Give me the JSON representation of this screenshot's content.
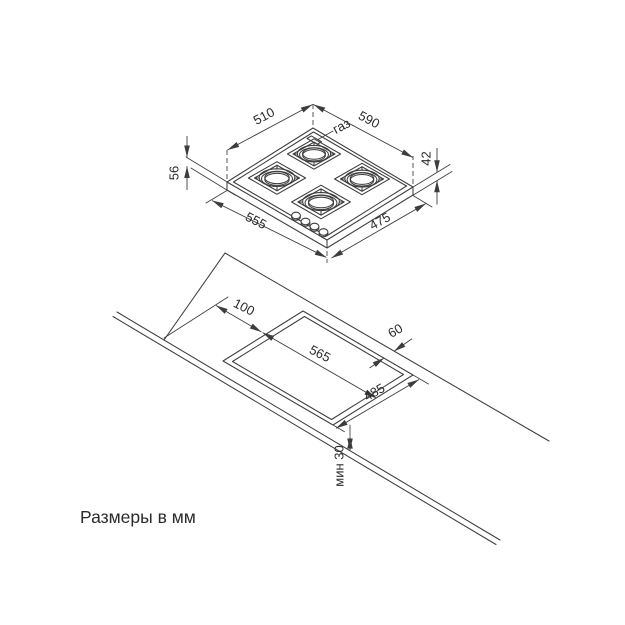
{
  "caption": "Размеры в мм",
  "hob": {
    "top_width": "510",
    "total_width": "590",
    "gas_label": "газ",
    "left_height": "56",
    "right_height": "42",
    "bottom_left_width": "555",
    "bottom_right_depth": "475"
  },
  "worktop": {
    "left_offset": "100",
    "back_gap": "60",
    "cutout_width": "565",
    "cutout_depth": "485",
    "front_min_gap": "мин 30"
  },
  "colors": {
    "line": "#3d3d3d",
    "text": "#2b2b2b",
    "background": "#ffffff"
  }
}
